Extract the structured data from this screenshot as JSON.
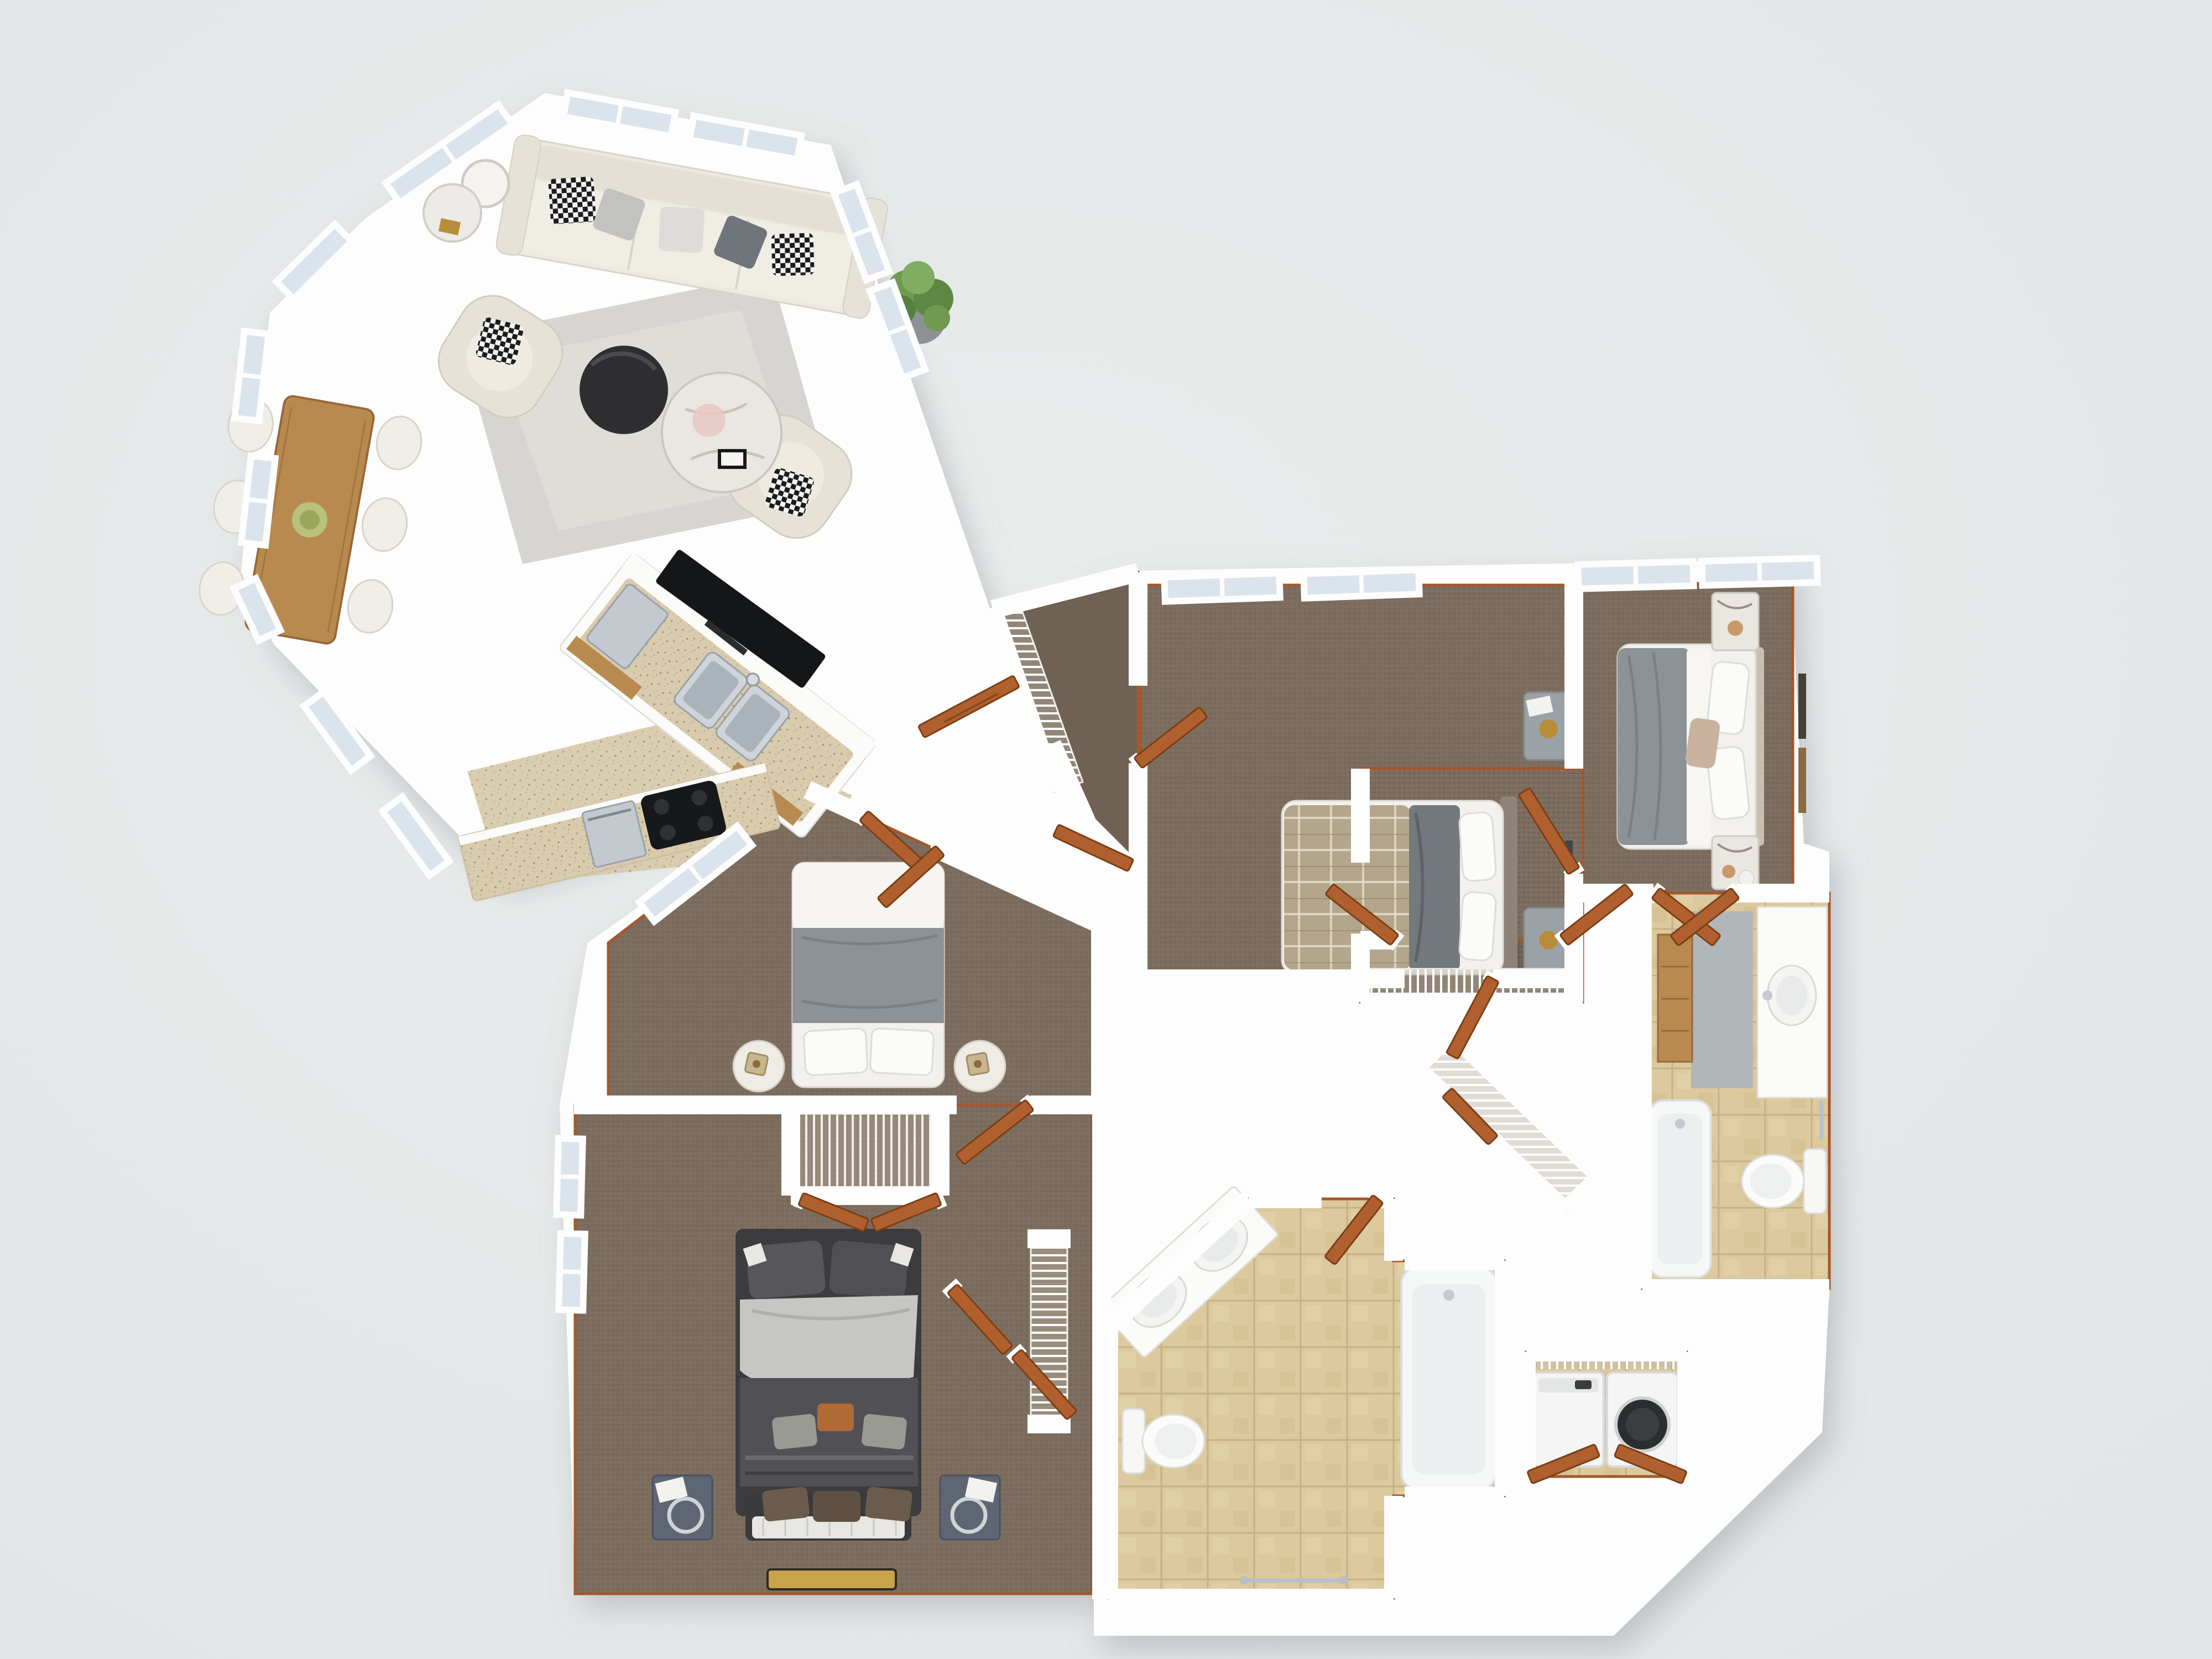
{
  "meta": {
    "kind": "3d-floorplan-render",
    "view": "top-down dollhouse",
    "visible_text": []
  },
  "palette": {
    "bg": "#e2e5e6",
    "bg_light": "#eaecec",
    "wall": "#fdfdfd",
    "wall_edge": "#e4e4e1",
    "beige_face": "#e9dfcc",
    "baseboard": "#a4582b",
    "wood_base": "#46382a",
    "carpet": "#7c6d5e",
    "carpet_dark": "#6f6153",
    "tile": "#dcc99e",
    "tile_grid": "#c6b184",
    "speckle": "#d8cbae",
    "door": "#b0602e",
    "door_edge": "#7c3e15",
    "glass": "#dbe4ec",
    "steel": "#c3c9cf",
    "steel_dark": "#9aa2aa",
    "marble": "#eae7e2",
    "sofa": "#edeae1",
    "bed_white": "#f2f1ee",
    "duvet_gray": "#8d9296",
    "plaid": "#b3a68c",
    "bed_dark": "#514f53",
    "nightstand_gray": "#9aa2a8",
    "nightstand_navy": "#5d6672",
    "rug": "#d7d5d1",
    "rug_gold": "#c8a34c",
    "gold": "#b98c3a",
    "plant": "#6f9a50",
    "shadow": "#9aa0a4",
    "wood_cab": "#b98a50",
    "tv": "#141618"
  },
  "rooms": [
    {
      "id": "great-room",
      "label": "living / dining / kitchen",
      "floor": "dark hardwood"
    },
    {
      "id": "bedroom-1",
      "label": "bedroom top-middle",
      "floor": "carpet"
    },
    {
      "id": "master-bedroom",
      "label": "bedroom right",
      "floor": "carpet"
    },
    {
      "id": "middle-bedroom",
      "label": "bedroom center-left",
      "floor": "carpet"
    },
    {
      "id": "bottom-bedroom",
      "label": "bedroom bottom-left",
      "floor": "carpet"
    },
    {
      "id": "master-bathroom",
      "label": "bathroom right",
      "floor": "tan tile"
    },
    {
      "id": "hall-bathroom",
      "label": "bathroom bottom",
      "floor": "tan tile"
    },
    {
      "id": "laundry-closet",
      "label": "laundry closet",
      "floor": "tile"
    },
    {
      "id": "hallway",
      "label": "diagonal hallway",
      "floor": "dark hardwood"
    },
    {
      "id": "walk-in-closet-1",
      "label": "closet with wire shelving",
      "floor": "carpet"
    },
    {
      "id": "master-closet",
      "label": "closet with wire shelving",
      "floor": "carpet"
    }
  ],
  "furniture": [
    "white sofa with five pillows",
    "two cream accent chairs",
    "black round coffee table",
    "white marble round table",
    "area rug",
    "floor lamp",
    "potted plant",
    "wood dining table with six white chairs",
    "kitchen island with double sink and tv",
    "kitchen counter with cooktop and oven",
    "queen bed plaid and gray",
    "queen bed gray with marble nightstands",
    "bed with gray band and round nightstands",
    "dark bed with bench and pillows",
    "washer and dryer",
    "two bathtubs",
    "two toilets",
    "double-sink angled vanity",
    "vanity with round sink and mirror",
    "wire shelving closets",
    "open wood doors",
    "gold accent rug"
  ],
  "counts": {
    "windows": 17,
    "door_leaves": 18,
    "wire_shelf_runs": 6
  }
}
